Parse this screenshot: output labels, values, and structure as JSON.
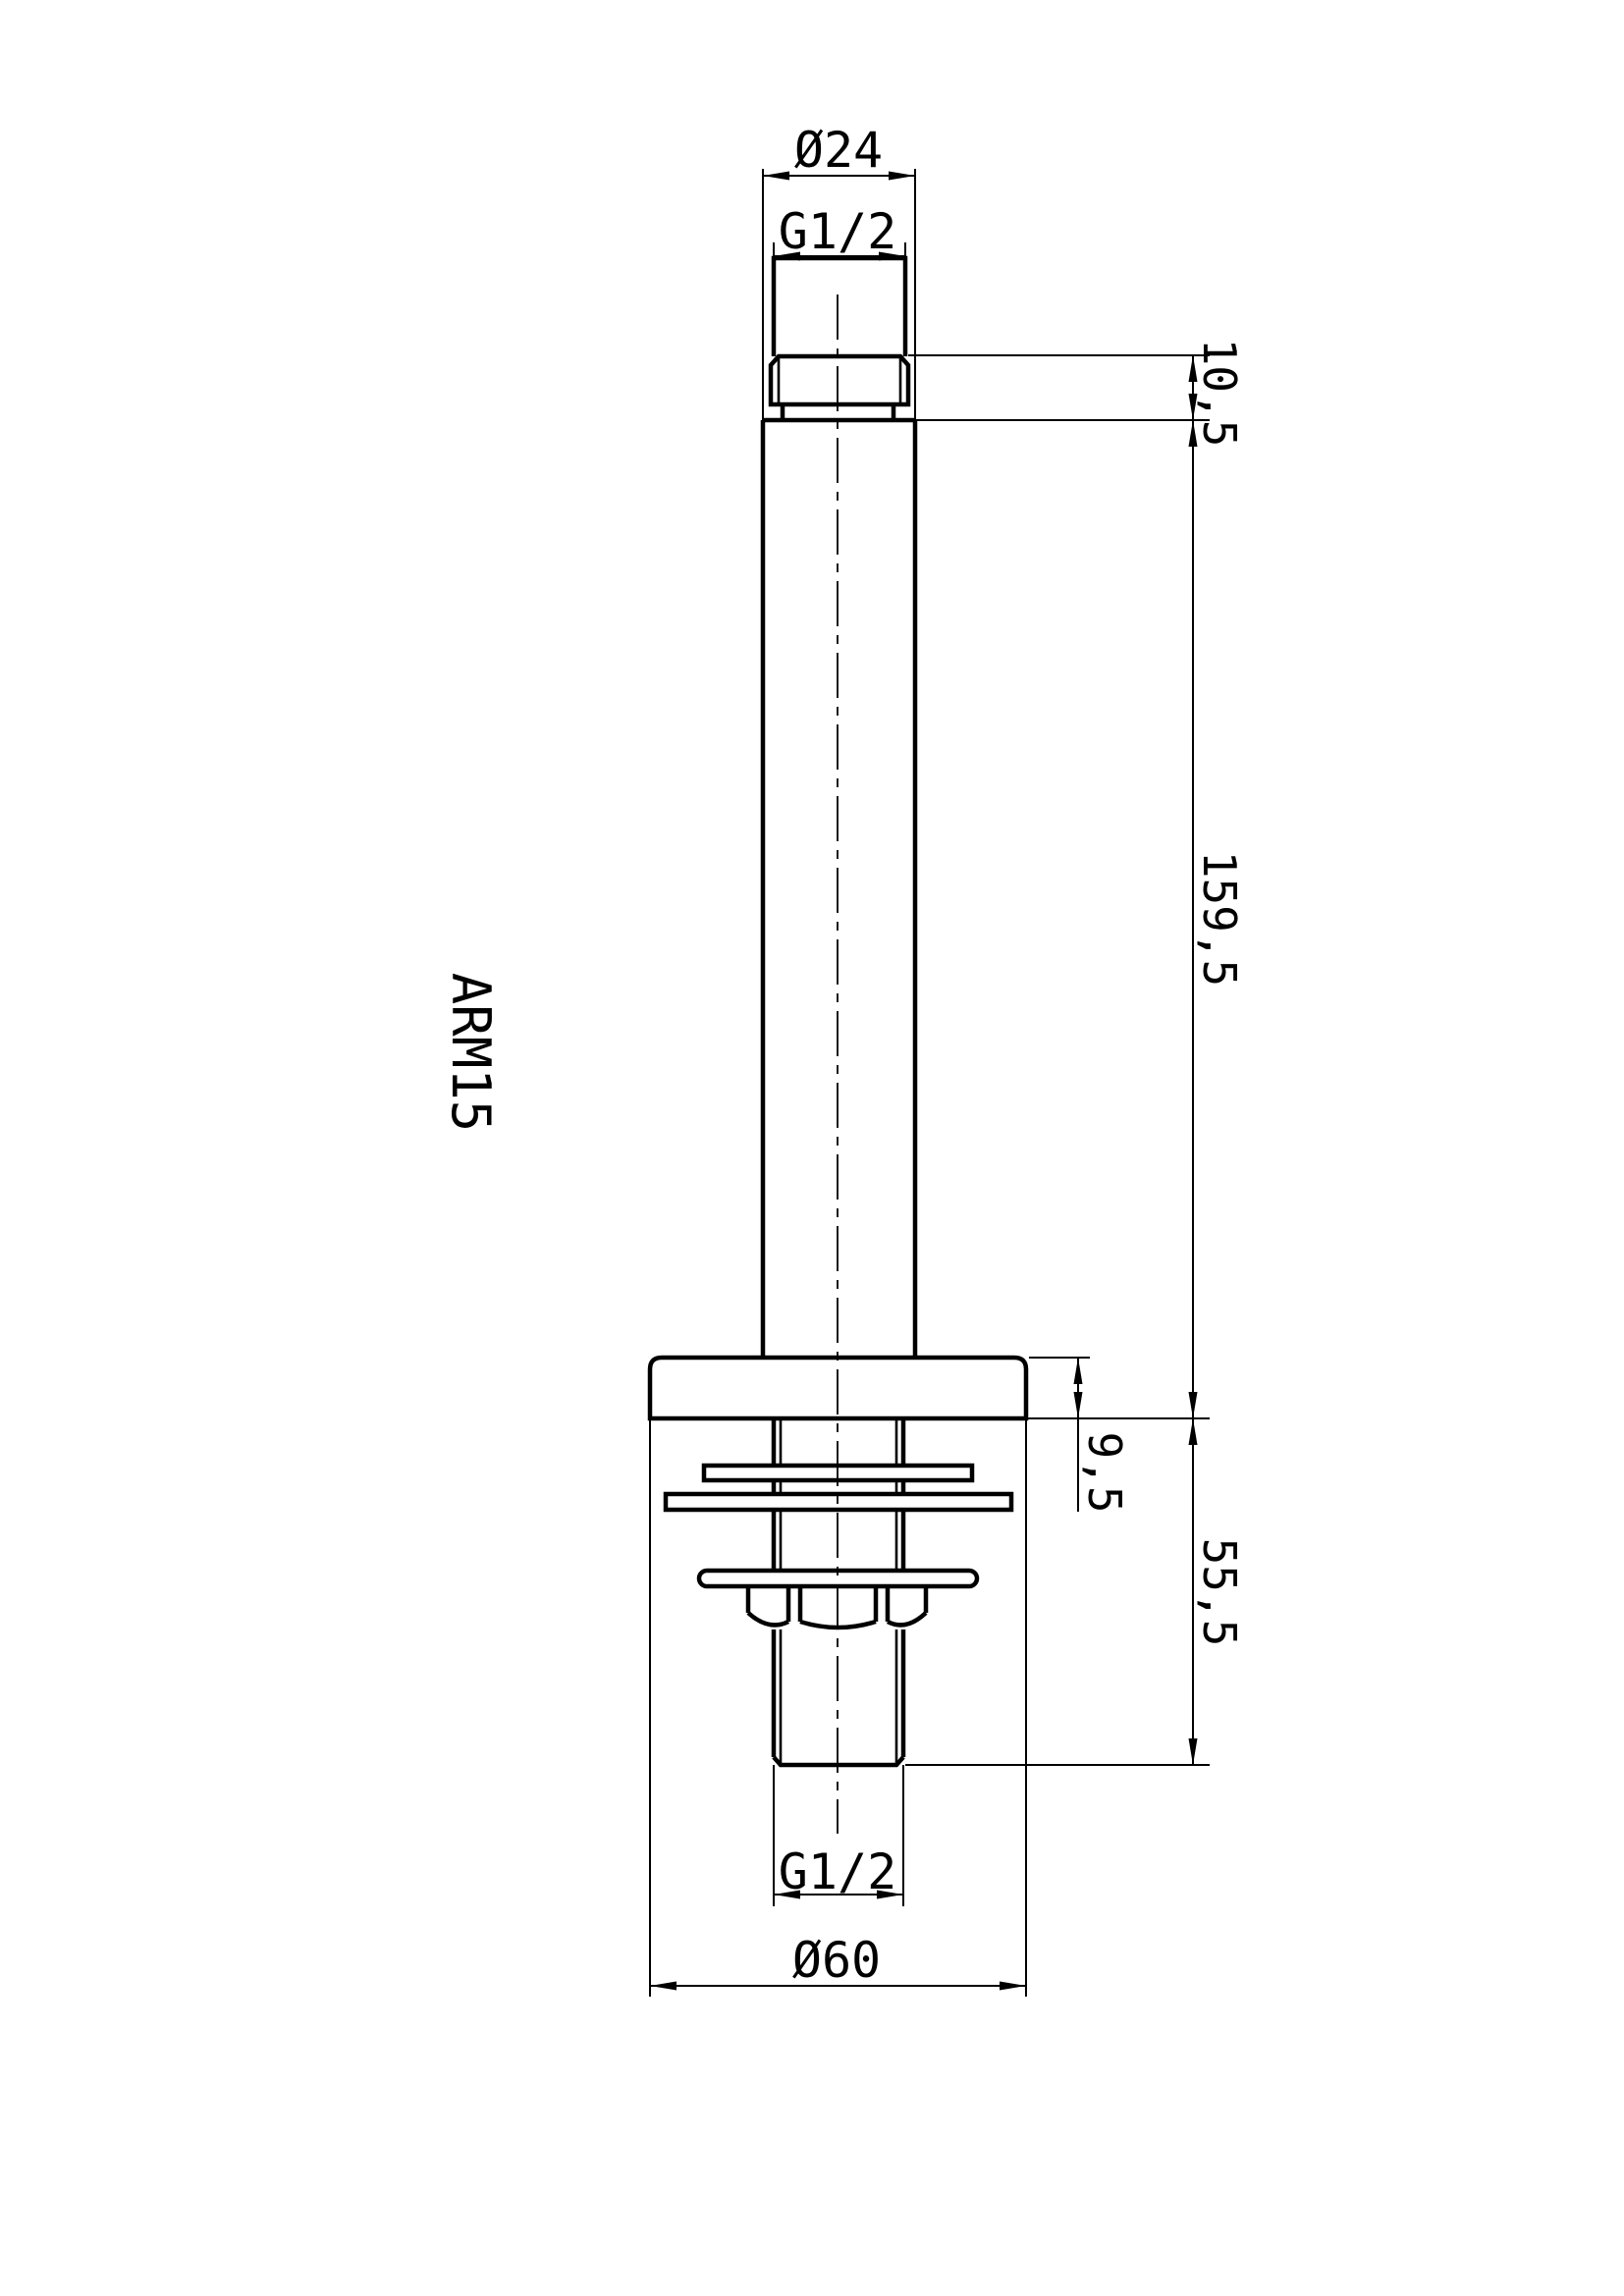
{
  "page": {
    "background": "#ffffff",
    "line_color": "#000000"
  },
  "drawing": {
    "part_label": "ARM15",
    "dimensions": {
      "top_diameter": "Ø24",
      "top_thread": "G1/2",
      "neck_height": "10,5",
      "arm_length": "159,5",
      "flange_thickness": "9,5",
      "tail_length": "55,5",
      "bottom_thread": "G1/2",
      "flange_diameter": "Ø60"
    }
  }
}
